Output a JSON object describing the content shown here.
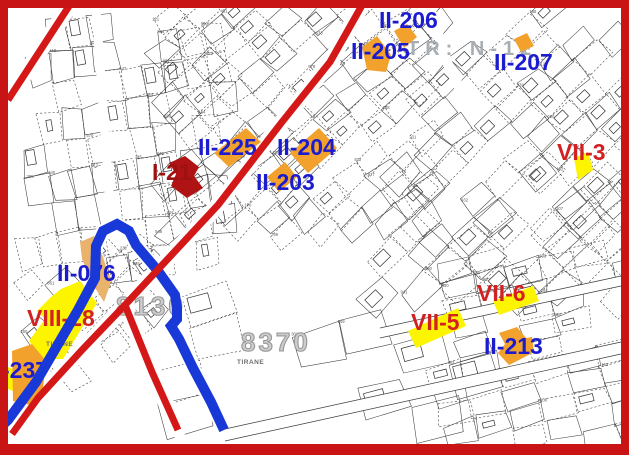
{
  "map": {
    "colors": {
      "orange": "#f2a12c",
      "tan": "#e9b36b",
      "yellow": "#fdf400",
      "darkred": "#b01313",
      "blue_line": "#1838d8",
      "red_line": "#d41717",
      "frame": "#c81414",
      "label_blue": "#1b1bd0",
      "label_red": "#d32121",
      "label_darkred": "#9e1111"
    },
    "zone_numbers": [
      {
        "text": "8130",
        "x": 116,
        "y": 291
      },
      {
        "text": "8370",
        "x": 241,
        "y": 327
      }
    ],
    "area_label": {
      "text": "TR: N-12",
      "x": 407,
      "y": 38
    },
    "small_labels": [
      {
        "text": "TIRANE",
        "x": 46,
        "y": 341
      },
      {
        "text": "TIRANE",
        "x": 237,
        "y": 359
      }
    ],
    "parcel_labels": [
      {
        "id": "II-206",
        "text": "II-206",
        "x": 379,
        "y": 8,
        "color": "blue"
      },
      {
        "id": "II-205",
        "text": "II-205",
        "x": 351,
        "y": 39,
        "color": "blue"
      },
      {
        "id": "II-207",
        "text": "II-207",
        "x": 494,
        "y": 50,
        "color": "blue"
      },
      {
        "id": "II-225",
        "text": "II-225",
        "x": 198,
        "y": 135,
        "color": "blue"
      },
      {
        "id": "II-204",
        "text": "II-204",
        "x": 277,
        "y": 135,
        "color": "blue"
      },
      {
        "id": "VII-3",
        "text": "VII-3",
        "x": 557,
        "y": 140,
        "color": "red"
      },
      {
        "id": "I-21",
        "text": "I-21",
        "x": 152,
        "y": 160,
        "color": "darkred"
      },
      {
        "id": "II-203",
        "text": "II-203",
        "x": 256,
        "y": 170,
        "color": "blue"
      },
      {
        "id": "II-076",
        "text": "II-076",
        "x": 57,
        "y": 261,
        "color": "blue"
      },
      {
        "id": "VIII-28",
        "text": "VIII-28",
        "x": 27,
        "y": 306,
        "color": "red"
      },
      {
        "id": "-237",
        "text": "-237",
        "x": 2,
        "y": 358,
        "color": "blue"
      },
      {
        "id": "VII-6",
        "text": "VII-6",
        "x": 477,
        "y": 281,
        "color": "red"
      },
      {
        "id": "VII-5",
        "text": "VII-5",
        "x": 411,
        "y": 310,
        "color": "red"
      },
      {
        "id": "II-213",
        "text": "II-213",
        "x": 484,
        "y": 334,
        "color": "blue"
      }
    ],
    "parcels": [
      {
        "name": "II-206",
        "fill": "orange",
        "pts": [
          [
            394,
            31
          ],
          [
            407,
            24
          ],
          [
            417,
            37
          ],
          [
            404,
            48
          ]
        ]
      },
      {
        "name": "II-205",
        "fill": "orange",
        "pts": [
          [
            362,
            47
          ],
          [
            377,
            36
          ],
          [
            391,
            55
          ],
          [
            386,
            72
          ],
          [
            367,
            70
          ]
        ]
      },
      {
        "name": "II-207",
        "fill": "orange",
        "pts": [
          [
            514,
            39
          ],
          [
            527,
            33
          ],
          [
            534,
            46
          ],
          [
            521,
            52
          ]
        ]
      },
      {
        "name": "II-225",
        "fill": "orange",
        "pts": [
          [
            214,
            153
          ],
          [
            246,
            128
          ],
          [
            261,
            142
          ],
          [
            229,
            167
          ]
        ]
      },
      {
        "name": "II-204",
        "fill": "orange",
        "pts": [
          [
            290,
            153
          ],
          [
            319,
            128
          ],
          [
            337,
            148
          ],
          [
            308,
            173
          ]
        ]
      },
      {
        "name": "II-203",
        "fill": "orange",
        "pts": [
          [
            267,
            177
          ],
          [
            285,
            162
          ],
          [
            297,
            177
          ],
          [
            279,
            192
          ]
        ]
      },
      {
        "name": "I-21",
        "fill": "darkred",
        "pts": [
          [
            169,
            163
          ],
          [
            185,
            156
          ],
          [
            199,
            167
          ],
          [
            194,
            176
          ],
          [
            203,
            188
          ],
          [
            187,
            198
          ],
          [
            171,
            186
          ],
          [
            176,
            174
          ]
        ]
      },
      {
        "name": "VII-3",
        "fill": "yellow",
        "pts": [
          [
            574,
            158
          ],
          [
            588,
            152
          ],
          [
            593,
            170
          ],
          [
            578,
            180
          ]
        ]
      },
      {
        "name": "II-076",
        "fill": "tan",
        "pts": [
          [
            80,
            242
          ],
          [
            94,
            236
          ],
          [
            103,
            257
          ],
          [
            111,
            282
          ],
          [
            104,
            302
          ],
          [
            92,
            283
          ],
          [
            82,
            259
          ]
        ]
      },
      {
        "name": "VIII-28",
        "fill": "yellow",
        "pts": [
          [
            61,
            289
          ],
          [
            80,
            281
          ],
          [
            97,
            303
          ],
          [
            63,
            359
          ],
          [
            41,
            359
          ],
          [
            29,
            341
          ],
          [
            45,
            319
          ],
          [
            37,
            311
          ],
          [
            51,
            297
          ]
        ]
      },
      {
        "name": "wedge",
        "fill": "yellow",
        "pts": [
          [
            8,
            367
          ],
          [
            19,
            372
          ],
          [
            13,
            391
          ],
          [
            8,
            389
          ]
        ]
      },
      {
        "name": "-237",
        "fill": "orange",
        "pts": [
          [
            12,
            351
          ],
          [
            32,
            344
          ],
          [
            46,
            361
          ],
          [
            43,
            388
          ],
          [
            30,
            405
          ],
          [
            13,
            401
          ]
        ]
      },
      {
        "name": "VII-5",
        "fill": "yellow",
        "pts": [
          [
            408,
            331
          ],
          [
            458,
            308
          ],
          [
            466,
            326
          ],
          [
            416,
            348
          ]
        ]
      },
      {
        "name": "VII-6",
        "fill": "yellow",
        "pts": [
          [
            493,
            301
          ],
          [
            533,
            286
          ],
          [
            539,
            301
          ],
          [
            499,
            315
          ]
        ]
      },
      {
        "name": "II-213",
        "fill": "orange",
        "pts": [
          [
            499,
            333
          ],
          [
            517,
            327
          ],
          [
            526,
            338
          ],
          [
            532,
            337
          ],
          [
            534,
            352
          ],
          [
            519,
            360
          ],
          [
            509,
            365
          ],
          [
            498,
            353
          ],
          [
            505,
            344
          ]
        ]
      }
    ],
    "lines": {
      "red": [
        {
          "pts": [
            [
              73,
              0
            ],
            [
              8,
              100
            ]
          ],
          "w": 7
        },
        {
          "pts": [
            [
              365,
              0
            ],
            [
              330,
              62
            ],
            [
              282,
              122
            ],
            [
              218,
              205
            ],
            [
              125,
              305
            ],
            [
              82,
              350
            ],
            [
              38,
              398
            ],
            [
              12,
              434
            ]
          ],
          "w": 7
        },
        {
          "pts": [
            [
              125,
              305
            ],
            [
              152,
              372
            ],
            [
              178,
              430
            ]
          ],
          "w": 7
        }
      ],
      "blue": [
        {
          "pts": [
            [
              -5,
              432
            ],
            [
              8,
              420
            ],
            [
              36,
              382
            ],
            [
              57,
              346
            ],
            [
              78,
              310
            ],
            [
              95,
              278
            ],
            [
              96,
              246
            ],
            [
              103,
              231
            ],
            [
              117,
              224
            ],
            [
              129,
              231
            ],
            [
              136,
              245
            ],
            [
              158,
              271
            ],
            [
              175,
              295
            ],
            [
              177,
              308
            ],
            [
              177,
              319
            ],
            [
              171,
              326
            ],
            [
              179,
              339
            ],
            [
              193,
              368
            ],
            [
              211,
              402
            ],
            [
              224,
              430
            ]
          ],
          "w": 10
        }
      ]
    }
  }
}
